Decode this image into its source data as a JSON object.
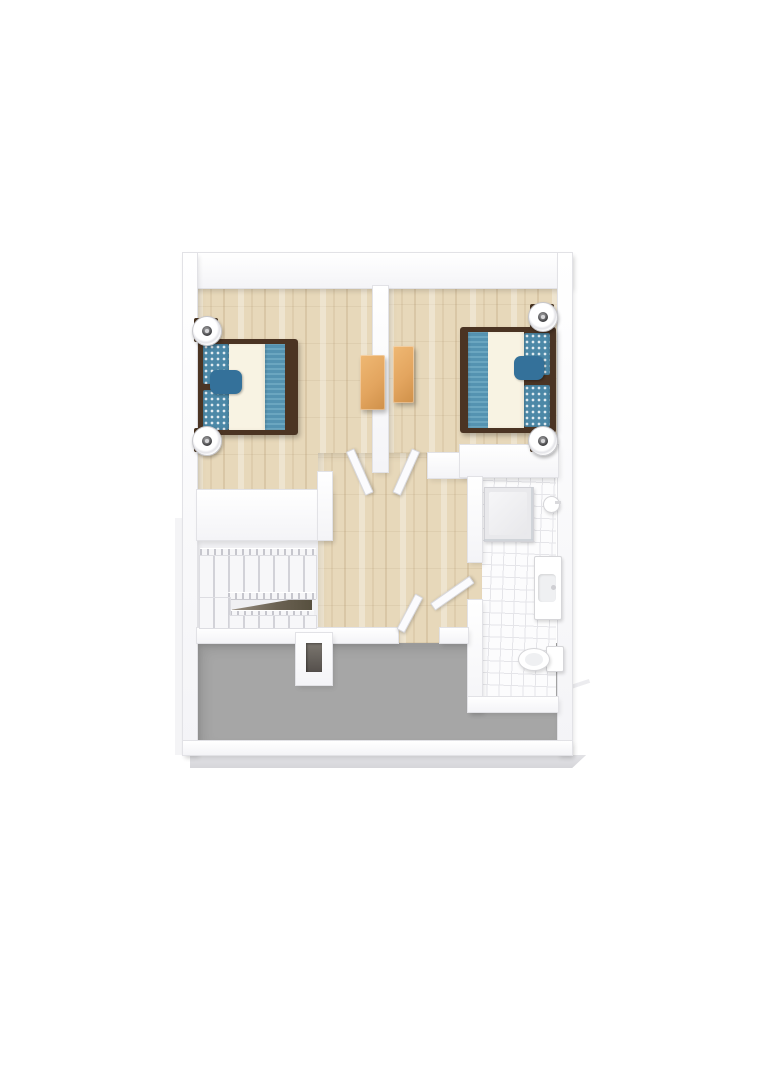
{
  "scene": {
    "type": "3d-floor-plan",
    "view": "top-down dollhouse render",
    "visible_text": "none"
  },
  "rooms": [
    {
      "name": "bedroom-left",
      "floor": "light wood plank"
    },
    {
      "name": "bedroom-right",
      "floor": "light wood plank"
    },
    {
      "name": "hallway",
      "floor": "light wood plank"
    },
    {
      "name": "stair-hall",
      "floor": "white"
    },
    {
      "name": "bathroom",
      "floor": "white tile grid"
    },
    {
      "name": "unfinished-gray-area",
      "floor": "flat gray"
    }
  ],
  "furniture": [
    {
      "name": "double-bed-left",
      "details": "dark wood frame, cream duvet, blue patterned pillows, blue striped foot runner, two round white lamps"
    },
    {
      "name": "double-bed-right",
      "details": "mirrored copy against right wall"
    },
    {
      "name": "dresser-left",
      "details": "orange tallboy against divider wall, left side"
    },
    {
      "name": "dresser-right",
      "details": "orange tallboy against divider wall, right side"
    },
    {
      "name": "u-shaped-staircase",
      "details": "white treads, spindle railings, dark stairwell void"
    },
    {
      "name": "shower-enclosure",
      "details": "square tray with glass screens and wall showerhead"
    },
    {
      "name": "vanity-sink",
      "details": "white unit on right wall"
    },
    {
      "name": "toilet",
      "details": "tank against right wall, bowl facing left"
    },
    {
      "name": "chimney-stub",
      "details": "hollow white rectangle protruding into gray area"
    }
  ],
  "doors": [
    {
      "name": "door-bedroom-left",
      "state": "open into bedroom"
    },
    {
      "name": "door-bedroom-right",
      "state": "open into bedroom"
    },
    {
      "name": "door-bathroom",
      "state": "open into hallway"
    },
    {
      "name": "door-gray-area",
      "state": "open into hallway"
    }
  ],
  "palette": {
    "wood-base": "#e7d8ba",
    "wall": "#fbfbfd",
    "wall-edge": "#e2e2e6",
    "gray-floor": "#a6a6a6",
    "tile": "#fcfcfd",
    "tile-line": "#e5e5e9",
    "stair-floor": "#f0f0f3",
    "bed-frame": "#4b3423",
    "duvet": "#f8f3e3",
    "pillow-blue": "#4c88a7",
    "accent-blue": "#34719a",
    "runner-blue": "#5593b1",
    "runner-stripe": "#6ba6c0",
    "dresser-orange": "#e3a55f",
    "slab": "#dcdcdf"
  }
}
